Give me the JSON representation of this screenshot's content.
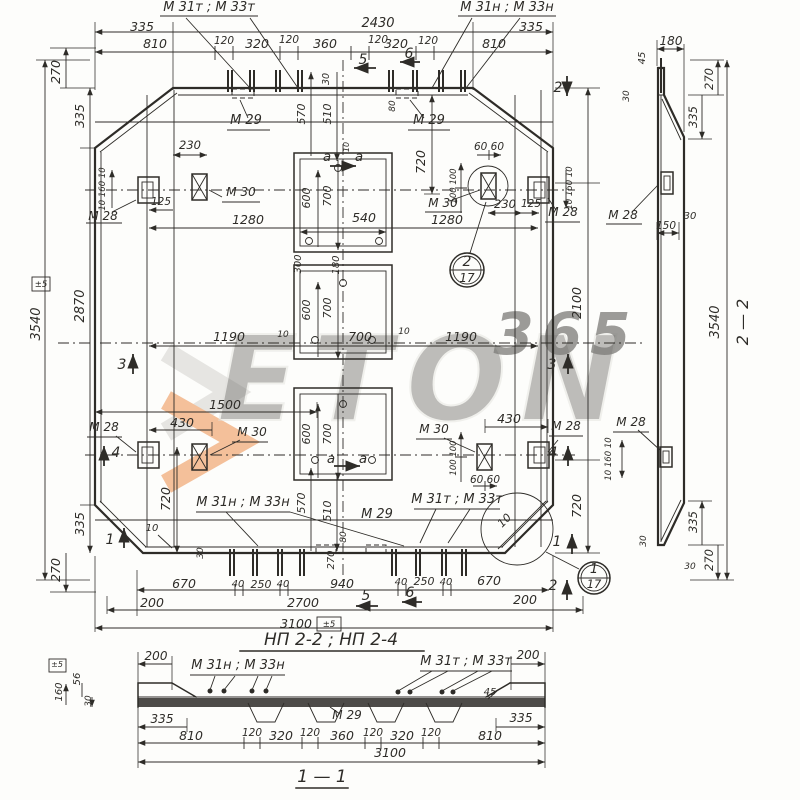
{
  "colors": {
    "ink": "#2e2c28",
    "paper": "#fdfdfb",
    "watermark_orange": "#ef9c60",
    "watermark_gray": "#d8d7d3"
  },
  "labels": [
    {
      "name": "watermark-brand",
      "text": "ETON",
      "x": 425,
      "y": 420,
      "size": 118,
      "layer": "wm",
      "fill": "#e9e8e3",
      "stroke": "#d2d1cb",
      "sw": 2,
      "weight": "bold",
      "spacing": 14,
      "opacity": 0.5
    },
    {
      "name": "watermark-365",
      "text": "365",
      "x": 566,
      "y": 354,
      "size": 58,
      "layer": "wm",
      "fill": "#ef9c60",
      "weight": "bold",
      "spacing": 8,
      "opacity": 0.75
    },
    {
      "name": "top-left-bars-label",
      "text": "М 31т ; М 33т",
      "x": 209,
      "y": 11,
      "size": 13
    },
    {
      "name": "top-right-bars-label",
      "text": "М 31н ; М 33н",
      "x": 507,
      "y": 11,
      "size": 13
    },
    {
      "name": "dim-2430",
      "text": "2430",
      "x": 378,
      "y": 27,
      "size": 13
    },
    {
      "name": "dim-335-top-left",
      "text": "335",
      "x": 142,
      "y": 31
    },
    {
      "name": "dim-335-top-right",
      "text": "335",
      "x": 531,
      "y": 31
    },
    {
      "name": "dim-810-top-left",
      "text": "810",
      "x": 155,
      "y": 48
    },
    {
      "name": "dim-120-top-1",
      "text": "120",
      "x": 224,
      "y": 44,
      "size": 10.5
    },
    {
      "name": "dim-320-top-left",
      "text": "320",
      "x": 257,
      "y": 48
    },
    {
      "name": "dim-120-top-2",
      "text": "120",
      "x": 289,
      "y": 43,
      "size": 10.5
    },
    {
      "name": "dim-360-top",
      "text": "360",
      "x": 325,
      "y": 48
    },
    {
      "name": "dim-120-top-3",
      "text": "120",
      "x": 378,
      "y": 43,
      "size": 10.5
    },
    {
      "name": "dim-320-top-right",
      "text": "320",
      "x": 396,
      "y": 48
    },
    {
      "name": "dim-120-top-4",
      "text": "120",
      "x": 428,
      "y": 44,
      "size": 10.5
    },
    {
      "name": "dim-810-top-right",
      "text": "810",
      "x": 494,
      "y": 48
    },
    {
      "name": "dim-30-top",
      "text": "30",
      "x": 329,
      "y": 79,
      "rot": -90,
      "size": 9.5
    },
    {
      "name": "marker-5-top",
      "text": "5",
      "x": 363,
      "y": 64,
      "size": 14
    },
    {
      "name": "marker-6-top",
      "text": "6",
      "x": 409,
      "y": 58,
      "size": 14
    },
    {
      "name": "marker-2-top",
      "text": "2",
      "x": 558,
      "y": 92,
      "size": 14
    },
    {
      "name": "dim-270-left-top",
      "text": "270",
      "x": 60,
      "y": 72,
      "rot": -90
    },
    {
      "name": "dim-335-left-top",
      "text": "335",
      "x": 84,
      "y": 116,
      "rot": -90
    },
    {
      "name": "dim-3540-left",
      "text": "3540",
      "x": 40,
      "y": 324,
      "rot": -90,
      "size": 13
    },
    {
      "name": "tol-3540",
      "text": "±5",
      "x": 41,
      "y": 287,
      "size": 8.5
    },
    {
      "name": "dim-2870-left",
      "text": "2870",
      "x": 84,
      "y": 306,
      "rot": -90,
      "size": 13
    },
    {
      "name": "dim-335-left-bottom",
      "text": "335",
      "x": 84,
      "y": 524,
      "rot": -90
    },
    {
      "name": "dim-270-left-bottom",
      "text": "270",
      "x": 60,
      "y": 570,
      "rot": -90
    },
    {
      "name": "marker-1-left",
      "text": "1",
      "x": 110,
      "y": 544,
      "size": 14
    },
    {
      "name": "marker-3-left",
      "text": "3",
      "x": 122,
      "y": 369,
      "size": 14
    },
    {
      "name": "marker-4-left",
      "text": "4",
      "x": 116,
      "y": 457,
      "size": 14
    },
    {
      "name": "dim-10-160-10-left",
      "text": "10 160 10",
      "x": 105,
      "y": 189,
      "rot": -90,
      "size": 8.5
    },
    {
      "name": "dim-125-left",
      "text": "125",
      "x": 161,
      "y": 205,
      "size": 10.5
    },
    {
      "name": "label-m28-top-left",
      "text": "М 28",
      "x": 103,
      "y": 220,
      "size": 12
    },
    {
      "name": "label-m30-top-left",
      "text": "М 30",
      "x": 241,
      "y": 196,
      "size": 12
    },
    {
      "name": "dim-230-top-left",
      "text": "230",
      "x": 190,
      "y": 149,
      "size": 11.5
    },
    {
      "name": "dim-1280-left",
      "text": "1280",
      "x": 248,
      "y": 224
    },
    {
      "name": "label-m29-top-left",
      "text": "М 29",
      "x": 246,
      "y": 124,
      "size": 13
    },
    {
      "name": "label-m29-top-right",
      "text": "М 29",
      "x": 429,
      "y": 124,
      "size": 13
    },
    {
      "name": "dim-570-top",
      "text": "570",
      "x": 305,
      "y": 114,
      "rot": -90,
      "size": 11
    },
    {
      "name": "dim-510-top",
      "text": "510",
      "x": 331,
      "y": 114,
      "rot": -90,
      "size": 11
    },
    {
      "name": "dim-80-top",
      "text": "80",
      "x": 395,
      "y": 106,
      "rot": -90,
      "size": 9
    },
    {
      "name": "dim-720-top-center",
      "text": "720",
      "x": 425,
      "y": 162,
      "rot": -90
    },
    {
      "name": "sec-a-top-left",
      "text": "а",
      "x": 327,
      "y": 161,
      "size": 13.5
    },
    {
      "name": "sec-a-top-right",
      "text": "а",
      "x": 359,
      "y": 161,
      "size": 13.5
    },
    {
      "name": "dim-600-o1",
      "text": "600",
      "x": 310,
      "y": 198,
      "rot": -90,
      "size": 11
    },
    {
      "name": "dim-700-o1",
      "text": "700",
      "x": 331,
      "y": 196,
      "rot": -90,
      "size": 11
    },
    {
      "name": "dim-10-o1",
      "text": "10",
      "x": 349,
      "y": 147,
      "rot": -90,
      "size": 8
    },
    {
      "name": "dim-540-o1",
      "text": "540",
      "x": 364,
      "y": 222
    },
    {
      "name": "dim-1280-right",
      "text": "1280",
      "x": 447,
      "y": 224
    },
    {
      "name": "label-m30-top-right",
      "text": "М 30",
      "x": 443,
      "y": 207,
      "size": 12
    },
    {
      "name": "dim-60-60-top-right",
      "text": "60 60",
      "x": 489,
      "y": 150,
      "size": 10.5
    },
    {
      "name": "dim-100-100-top-right",
      "text": "100 100",
      "x": 456,
      "y": 186,
      "rot": -90,
      "size": 8.5
    },
    {
      "name": "dim-230-top-right",
      "text": "230",
      "x": 505,
      "y": 208,
      "size": 11.5
    },
    {
      "name": "dim-125-right",
      "text": "125",
      "x": 531,
      "y": 207,
      "size": 10.5
    },
    {
      "name": "label-m28-top-right",
      "text": "М 28",
      "x": 563,
      "y": 216,
      "size": 12
    },
    {
      "name": "dim-10-160-10-right",
      "text": "10 160 10",
      "x": 572,
      "y": 188,
      "rot": -90,
      "size": 8.5
    },
    {
      "name": "callout-2-num",
      "text": "2",
      "x": 467,
      "y": 266,
      "size": 14
    },
    {
      "name": "callout-2-sheet",
      "text": "17",
      "x": 467,
      "y": 282,
      "size": 12
    },
    {
      "name": "dim-1190-left",
      "text": "1190",
      "x": 229,
      "y": 341
    },
    {
      "name": "dim-10-mid-left",
      "text": "10",
      "x": 283,
      "y": 337,
      "size": 9
    },
    {
      "name": "dim-300-o2",
      "text": "300",
      "x": 301,
      "y": 264,
      "rot": -90,
      "size": 10
    },
    {
      "name": "dim-180-o2",
      "text": "180",
      "x": 339,
      "y": 265,
      "rot": -90,
      "size": 10
    },
    {
      "name": "dim-600-o2",
      "text": "600",
      "x": 310,
      "y": 310,
      "rot": -90,
      "size": 11
    },
    {
      "name": "dim-700-o2-v",
      "text": "700",
      "x": 331,
      "y": 308,
      "rot": -90,
      "size": 11
    },
    {
      "name": "dim-700-mid",
      "text": "700",
      "x": 360,
      "y": 341
    },
    {
      "name": "dim-10-mid-right",
      "text": "10",
      "x": 404,
      "y": 334,
      "size": 9
    },
    {
      "name": "dim-1190-right",
      "text": "1190",
      "x": 461,
      "y": 341
    },
    {
      "name": "dim-2100-right",
      "text": "2100",
      "x": 581,
      "y": 303,
      "rot": -90
    },
    {
      "name": "marker-3-right",
      "text": "3",
      "x": 552,
      "y": 369,
      "size": 14
    },
    {
      "name": "dim-1500",
      "text": "1500",
      "x": 225,
      "y": 409
    },
    {
      "name": "dim-430-bot-left",
      "text": "430",
      "x": 182,
      "y": 427
    },
    {
      "name": "label-m28-bot-left",
      "text": "М 28",
      "x": 104,
      "y": 431,
      "size": 12
    },
    {
      "name": "label-m30-bot-left",
      "text": "М 30",
      "x": 252,
      "y": 436,
      "size": 12
    },
    {
      "name": "dim-430-bot-right",
      "text": "430",
      "x": 509,
      "y": 423
    },
    {
      "name": "label-m30-bot-right",
      "text": "М 30",
      "x": 434,
      "y": 433,
      "size": 12
    },
    {
      "name": "label-m28-bot-right",
      "text": "М 28",
      "x": 566,
      "y": 430,
      "size": 12
    },
    {
      "name": "marker-4-right",
      "text": "4",
      "x": 553,
      "y": 457,
      "size": 14
    },
    {
      "name": "dim-100-100-bot-right",
      "text": "100 100",
      "x": 456,
      "y": 458,
      "rot": -90,
      "size": 8.5
    },
    {
      "name": "dim-60-60-bot-right",
      "text": "60 60",
      "x": 485,
      "y": 483,
      "size": 10.5
    },
    {
      "name": "dim-720-bot-left",
      "text": "720",
      "x": 170,
      "y": 499,
      "rot": -90
    },
    {
      "name": "dim-720-bot-right",
      "text": "720",
      "x": 581,
      "y": 506,
      "rot": -90
    },
    {
      "name": "dim-600-o3",
      "text": "600",
      "x": 310,
      "y": 434,
      "rot": -90,
      "size": 11
    },
    {
      "name": "dim-700-o3",
      "text": "700",
      "x": 331,
      "y": 434,
      "rot": -90,
      "size": 11
    },
    {
      "name": "sec-a-bot-left",
      "text": "а",
      "x": 331,
      "y": 463,
      "size": 13.5
    },
    {
      "name": "sec-a-bot-right",
      "text": "а",
      "x": 363,
      "y": 463,
      "size": 13.5
    },
    {
      "name": "label-bars-bot-left",
      "text": "М 31н ; М 33н",
      "x": 243,
      "y": 506,
      "size": 13
    },
    {
      "name": "dim-570-bot",
      "text": "570",
      "x": 305,
      "y": 503,
      "rot": -90,
      "size": 11
    },
    {
      "name": "dim-510-bot",
      "text": "510",
      "x": 331,
      "y": 511,
      "rot": -90,
      "size": 11
    },
    {
      "name": "dim-80-bot",
      "text": "80",
      "x": 346,
      "y": 537,
      "rot": -90,
      "size": 9
    },
    {
      "name": "label-m29-bot",
      "text": "М 29",
      "x": 377,
      "y": 518,
      "size": 13
    },
    {
      "name": "dim-270-bot",
      "text": "270",
      "x": 334,
      "y": 560,
      "rot": -90,
      "size": 10
    },
    {
      "name": "dim-10-bot-left",
      "text": "10",
      "x": 152,
      "y": 531,
      "size": 10
    },
    {
      "name": "dim-30-bot-left",
      "text": "30",
      "x": 203,
      "y": 553,
      "rot": -90,
      "size": 9
    },
    {
      "name": "label-bars-bot-right",
      "text": "М 31т ; М 33т",
      "x": 457,
      "y": 503,
      "size": 13
    },
    {
      "name": "detail-10",
      "text": "10",
      "x": 507,
      "y": 523,
      "rot": -45,
      "size": 11
    },
    {
      "name": "marker-1-right",
      "text": "1",
      "x": 557,
      "y": 546,
      "size": 14
    },
    {
      "name": "marker-2-bot",
      "text": "2",
      "x": 553,
      "y": 590,
      "size": 14
    },
    {
      "name": "callout-1-num",
      "text": "1",
      "x": 594,
      "y": 573,
      "size": 13
    },
    {
      "name": "callout-1-sheet",
      "text": "17",
      "x": 594,
      "y": 588,
      "size": 11.5
    },
    {
      "name": "dim-670-bot-left",
      "text": "670",
      "x": 184,
      "y": 588
    },
    {
      "name": "dim-40-bl1",
      "text": "40",
      "x": 238,
      "y": 587,
      "size": 10
    },
    {
      "name": "dim-250-bot-left",
      "text": "250",
      "x": 261,
      "y": 588,
      "size": 11
    },
    {
      "name": "dim-40-bl2",
      "text": "40",
      "x": 283,
      "y": 587,
      "size": 10
    },
    {
      "name": "dim-940",
      "text": "940",
      "x": 342,
      "y": 588
    },
    {
      "name": "dim-40-br1",
      "text": "40",
      "x": 401,
      "y": 585,
      "size": 10
    },
    {
      "name": "dim-250-bot-right",
      "text": "250",
      "x": 424,
      "y": 585,
      "size": 11
    },
    {
      "name": "dim-40-br2",
      "text": "40",
      "x": 446,
      "y": 585,
      "size": 10
    },
    {
      "name": "dim-670-bot-right",
      "text": "670",
      "x": 489,
      "y": 585
    },
    {
      "name": "dim-200-bot-left",
      "text": "200",
      "x": 152,
      "y": 607
    },
    {
      "name": "dim-2700",
      "text": "2700",
      "x": 303,
      "y": 607
    },
    {
      "name": "marker-5-bot",
      "text": "5",
      "x": 366,
      "y": 600,
      "size": 14
    },
    {
      "name": "marker-6-bot",
      "text": "6",
      "x": 410,
      "y": 597,
      "size": 14
    },
    {
      "name": "dim-200-bot-right",
      "text": "200",
      "x": 525,
      "y": 604
    },
    {
      "name": "dim-3100-plan",
      "text": "3100",
      "x": 296,
      "y": 628
    },
    {
      "name": "tol-3100",
      "text": "±5",
      "x": 329,
      "y": 627,
      "size": 8.5
    },
    {
      "name": "title-plan",
      "text": "НП 2-2  ;  НП 2-4",
      "x": 331,
      "y": 645,
      "size": 17
    },
    {
      "name": "dim-180-s2",
      "text": "180",
      "x": 671,
      "y": 45,
      "size": 12
    },
    {
      "name": "dim-45-s2",
      "text": "45",
      "x": 645,
      "y": 58,
      "rot": -90,
      "size": 10
    },
    {
      "name": "dim-30-s2-topleft",
      "text": "30",
      "x": 629,
      "y": 96,
      "rot": -90,
      "size": 9
    },
    {
      "name": "dim-270-s2-top",
      "text": "270",
      "x": 713,
      "y": 79,
      "rot": -90,
      "size": 11.5
    },
    {
      "name": "dim-335-s2-top",
      "text": "335",
      "x": 697,
      "y": 117,
      "rot": -90,
      "size": 11.5
    },
    {
      "name": "label-m28-s2-top",
      "text": "М 28",
      "x": 623,
      "y": 219,
      "size": 12
    },
    {
      "name": "dim-150-s2-top",
      "text": "150",
      "x": 666,
      "y": 229,
      "size": 10.5
    },
    {
      "name": "dim-30-s2-mid",
      "text": "30",
      "x": 690,
      "y": 219,
      "size": 10
    },
    {
      "name": "label-m28-s2-bot",
      "text": "М 28",
      "x": 631,
      "y": 426,
      "size": 12
    },
    {
      "name": "dim-10-160-10-s2",
      "text": "10 160 10",
      "x": 611,
      "y": 459,
      "rot": -90,
      "size": 8.5
    },
    {
      "name": "dim-3540-s2",
      "text": "3540",
      "x": 719,
      "y": 322,
      "rot": -90,
      "size": 13
    },
    {
      "name": "title-section2",
      "text": "2 — 2",
      "x": 748,
      "y": 322,
      "rot": -90,
      "size": 16
    },
    {
      "name": "dim-30-s2-botleft",
      "text": "30",
      "x": 646,
      "y": 541,
      "rot": -90,
      "size": 9
    },
    {
      "name": "dim-335-s2-bot",
      "text": "335",
      "x": 697,
      "y": 522,
      "rot": -90,
      "size": 11.5
    },
    {
      "name": "dim-30-s2-bot",
      "text": "30",
      "x": 690,
      "y": 569,
      "size": 9
    },
    {
      "name": "dim-270-s2-bot",
      "text": "270",
      "x": 713,
      "y": 560,
      "rot": -90,
      "size": 11.5
    },
    {
      "name": "dim-200-s1-left",
      "text": "200",
      "x": 156,
      "y": 660,
      "size": 12
    },
    {
      "name": "tol-160-s1",
      "text": "±5",
      "x": 57,
      "y": 667,
      "size": 8
    },
    {
      "name": "dim-160-s1",
      "text": "160",
      "x": 62,
      "y": 692,
      "rot": -90,
      "size": 10
    },
    {
      "name": "dim-56-s1",
      "text": "56",
      "x": 80,
      "y": 679,
      "rot": -90,
      "size": 10
    },
    {
      "name": "dim-30-s1-left",
      "text": "30",
      "x": 91,
      "y": 701,
      "rot": -90,
      "size": 9
    },
    {
      "name": "label-bars-s1-left",
      "text": "М 31н ; М 33н",
      "x": 238,
      "y": 669,
      "size": 13
    },
    {
      "name": "label-bars-s1-right",
      "text": "М 31т ; М 33т",
      "x": 466,
      "y": 665,
      "size": 13
    },
    {
      "name": "label-m29-s1",
      "text": "М 29",
      "x": 347,
      "y": 719,
      "size": 12
    },
    {
      "name": "dim-45-s1",
      "text": "45",
      "x": 490,
      "y": 695,
      "size": 10
    },
    {
      "name": "dim-335-s1-left",
      "text": "335",
      "x": 162,
      "y": 723,
      "size": 12
    },
    {
      "name": "dim-810-s1-left",
      "text": "810",
      "x": 191,
      "y": 740
    },
    {
      "name": "dim-120-s1-1",
      "text": "120",
      "x": 252,
      "y": 736,
      "size": 10.5
    },
    {
      "name": "dim-320-s1-left",
      "text": "320",
      "x": 281,
      "y": 740
    },
    {
      "name": "dim-120-s1-2",
      "text": "120",
      "x": 310,
      "y": 736,
      "size": 10.5
    },
    {
      "name": "dim-360-s1",
      "text": "360",
      "x": 342,
      "y": 740
    },
    {
      "name": "dim-120-s1-3",
      "text": "120",
      "x": 373,
      "y": 736,
      "size": 10.5
    },
    {
      "name": "dim-320-s1-right",
      "text": "320",
      "x": 402,
      "y": 740
    },
    {
      "name": "dim-120-s1-4",
      "text": "120",
      "x": 431,
      "y": 736,
      "size": 10.5
    },
    {
      "name": "dim-810-s1-right",
      "text": "810",
      "x": 490,
      "y": 740
    },
    {
      "name": "dim-335-s1-right",
      "text": "335",
      "x": 521,
      "y": 722,
      "size": 12
    },
    {
      "name": "dim-200-s1-right",
      "text": "200",
      "x": 528,
      "y": 659,
      "size": 12
    },
    {
      "name": "dim-3100-s1",
      "text": "3100",
      "x": 390,
      "y": 757
    },
    {
      "name": "title-section1",
      "text": "1 — 1",
      "x": 322,
      "y": 782,
      "size": 17
    }
  ]
}
